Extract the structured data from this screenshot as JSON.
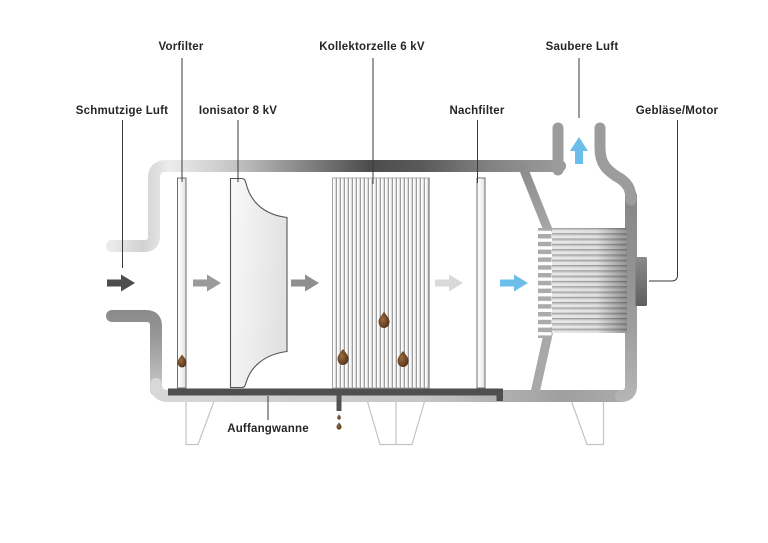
{
  "diagram": {
    "type": "schematic",
    "subject": "Electrostatic air cleaner cross-section (German labels)"
  },
  "labels": {
    "schmutzige_luft": "Schmutzige Luft",
    "vorfilter": "Vorfilter",
    "ionisator": "Ionisator 8 kV",
    "kollektorzelle": "Kollektorzelle 6 kV",
    "nachfilter": "Nachfilter",
    "saubere_luft": "Saubere Luft",
    "geblaese_motor": "Gebläse/Motor",
    "auffangwanne": "Auffangwanne"
  },
  "components": [
    {
      "name": "inlet-duct",
      "label_ref": "schmutzige_luft"
    },
    {
      "name": "pre-filter",
      "label_ref": "vorfilter"
    },
    {
      "name": "ionizer",
      "label_ref": "ionisator",
      "voltage": "8 kV"
    },
    {
      "name": "collector-cell",
      "label_ref": "kollektorzelle",
      "voltage": "6 kV"
    },
    {
      "name": "post-filter",
      "label_ref": "nachfilter"
    },
    {
      "name": "exhaust-chimney",
      "label_ref": "saubere_luft"
    },
    {
      "name": "blower-motor",
      "label_ref": "geblaese_motor"
    },
    {
      "name": "drip-tray",
      "label_ref": "auffangwanne"
    }
  ],
  "flow": {
    "arrows": [
      {
        "name": "dirty-air-arrow",
        "direction": "right",
        "color": "#4d4d4d"
      },
      {
        "name": "after-vorfilter-arrow",
        "direction": "right",
        "color": "#9a9a9a"
      },
      {
        "name": "after-ionisator-arrow",
        "direction": "right",
        "color": "#8f8f8f"
      },
      {
        "name": "after-kollektor-arrow",
        "direction": "right",
        "color": "#d9d9d9"
      },
      {
        "name": "after-nachfilter-arrow",
        "direction": "right",
        "color": "#6cbde9"
      },
      {
        "name": "clean-air-arrow",
        "direction": "up",
        "color": "#6cbde9"
      }
    ]
  },
  "colors": {
    "housing_dark": "#4c4c4c",
    "housing_mid": "#9a9a9a",
    "housing_light": "#ececec",
    "tray": "#4f4f4f",
    "droplet": "#4a2a12",
    "leader_line": "#3a3a3a",
    "label_text": "#262626",
    "leg_outline": "#c4c4c4",
    "clean_air_blue": "#6cbde9"
  }
}
